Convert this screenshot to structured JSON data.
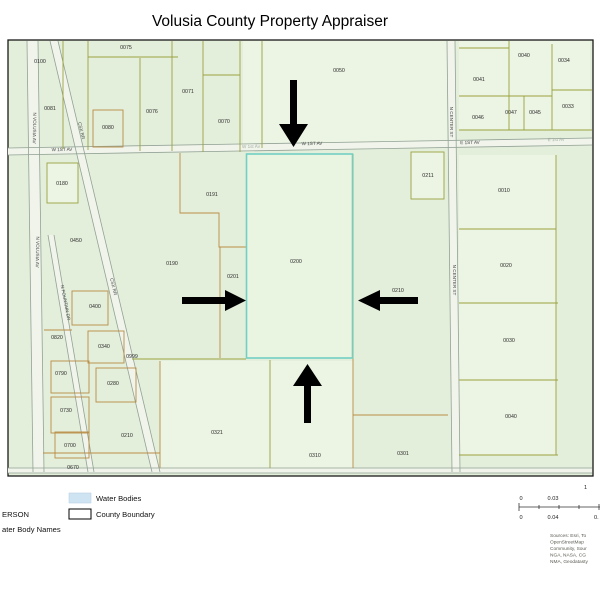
{
  "title": "Volusia County Property Appraiser",
  "map": {
    "parcels": [
      {
        "id": "0100"
      },
      {
        "id": "0075"
      },
      {
        "id": "0071"
      },
      {
        "id": "0081"
      },
      {
        "id": "0076"
      },
      {
        "id": "0080"
      },
      {
        "id": "0070"
      },
      {
        "id": "0050"
      },
      {
        "id": "0040"
      },
      {
        "id": "0034"
      },
      {
        "id": "0041"
      },
      {
        "id": "0047"
      },
      {
        "id": "0045"
      },
      {
        "id": "0046"
      },
      {
        "id": "0033"
      },
      {
        "id": "0180"
      },
      {
        "id": "0191"
      },
      {
        "id": "0211"
      },
      {
        "id": "0010"
      },
      {
        "id": "0450"
      },
      {
        "id": "0190"
      },
      {
        "id": "0201"
      },
      {
        "id": "0200"
      },
      {
        "id": "0020"
      },
      {
        "id": "0210"
      },
      {
        "id": "0400"
      },
      {
        "id": "0820"
      },
      {
        "id": "0340"
      },
      {
        "id": "0999"
      },
      {
        "id": "0790"
      },
      {
        "id": "0280"
      },
      {
        "id": "0730"
      },
      {
        "id": "0210"
      },
      {
        "id": "0700"
      },
      {
        "id": "0670"
      },
      {
        "id": "0321"
      },
      {
        "id": "0310"
      },
      {
        "id": "0030"
      },
      {
        "id": "0040"
      },
      {
        "id": "0301"
      }
    ],
    "streets": {
      "n_volusia_av_1": "N VOLUSIA AV",
      "n_volusia_av_2": "N VOLUSIA AV",
      "csx_rr_1": "CSX RR",
      "csx_rr_2": "CSX RR",
      "n_fountain_dr": "N FOUNTAIN DR",
      "n_center_st_1": "N CENTER ST",
      "n_center_st_2": "N CENTER ST",
      "w_1st_av_left": "W 1ST AV",
      "w_1st_av_faint": "W 1st Av",
      "w_1st_av_mid": "W 1ST AV",
      "e_1st_av": "E 1ST AV",
      "e_1st_av_faint": "E 1st Av"
    }
  },
  "legend": {
    "water_bodies": "Water Bodies",
    "county_boundary": "County Boundary",
    "cutoff_line_1": "ERSON",
    "cutoff_line_2": "ater Body Names"
  },
  "scale": {
    "ratio_prefix": "1",
    "top_tick_0": "0",
    "top_tick_1": "0.03",
    "bottom_tick_0": "0",
    "bottom_tick_1": "0.04",
    "bottom_tick_2": "0."
  },
  "sources": [
    "Sources: Esri, To",
    "OpenStreetMap",
    "Community, Sour",
    "NGA, NASA, CG",
    "NMA, Geodatasty"
  ],
  "colors": {
    "map_bg": "#e4efdb",
    "parcel_light": "#ecf4e3",
    "line_olive": "#9aa23f",
    "line_tan": "#b98c44",
    "highlight_cyan": "#72cfc2",
    "road_edge": "#93a296",
    "water_legend": "#cfe4f2",
    "arrow": "#000000"
  }
}
